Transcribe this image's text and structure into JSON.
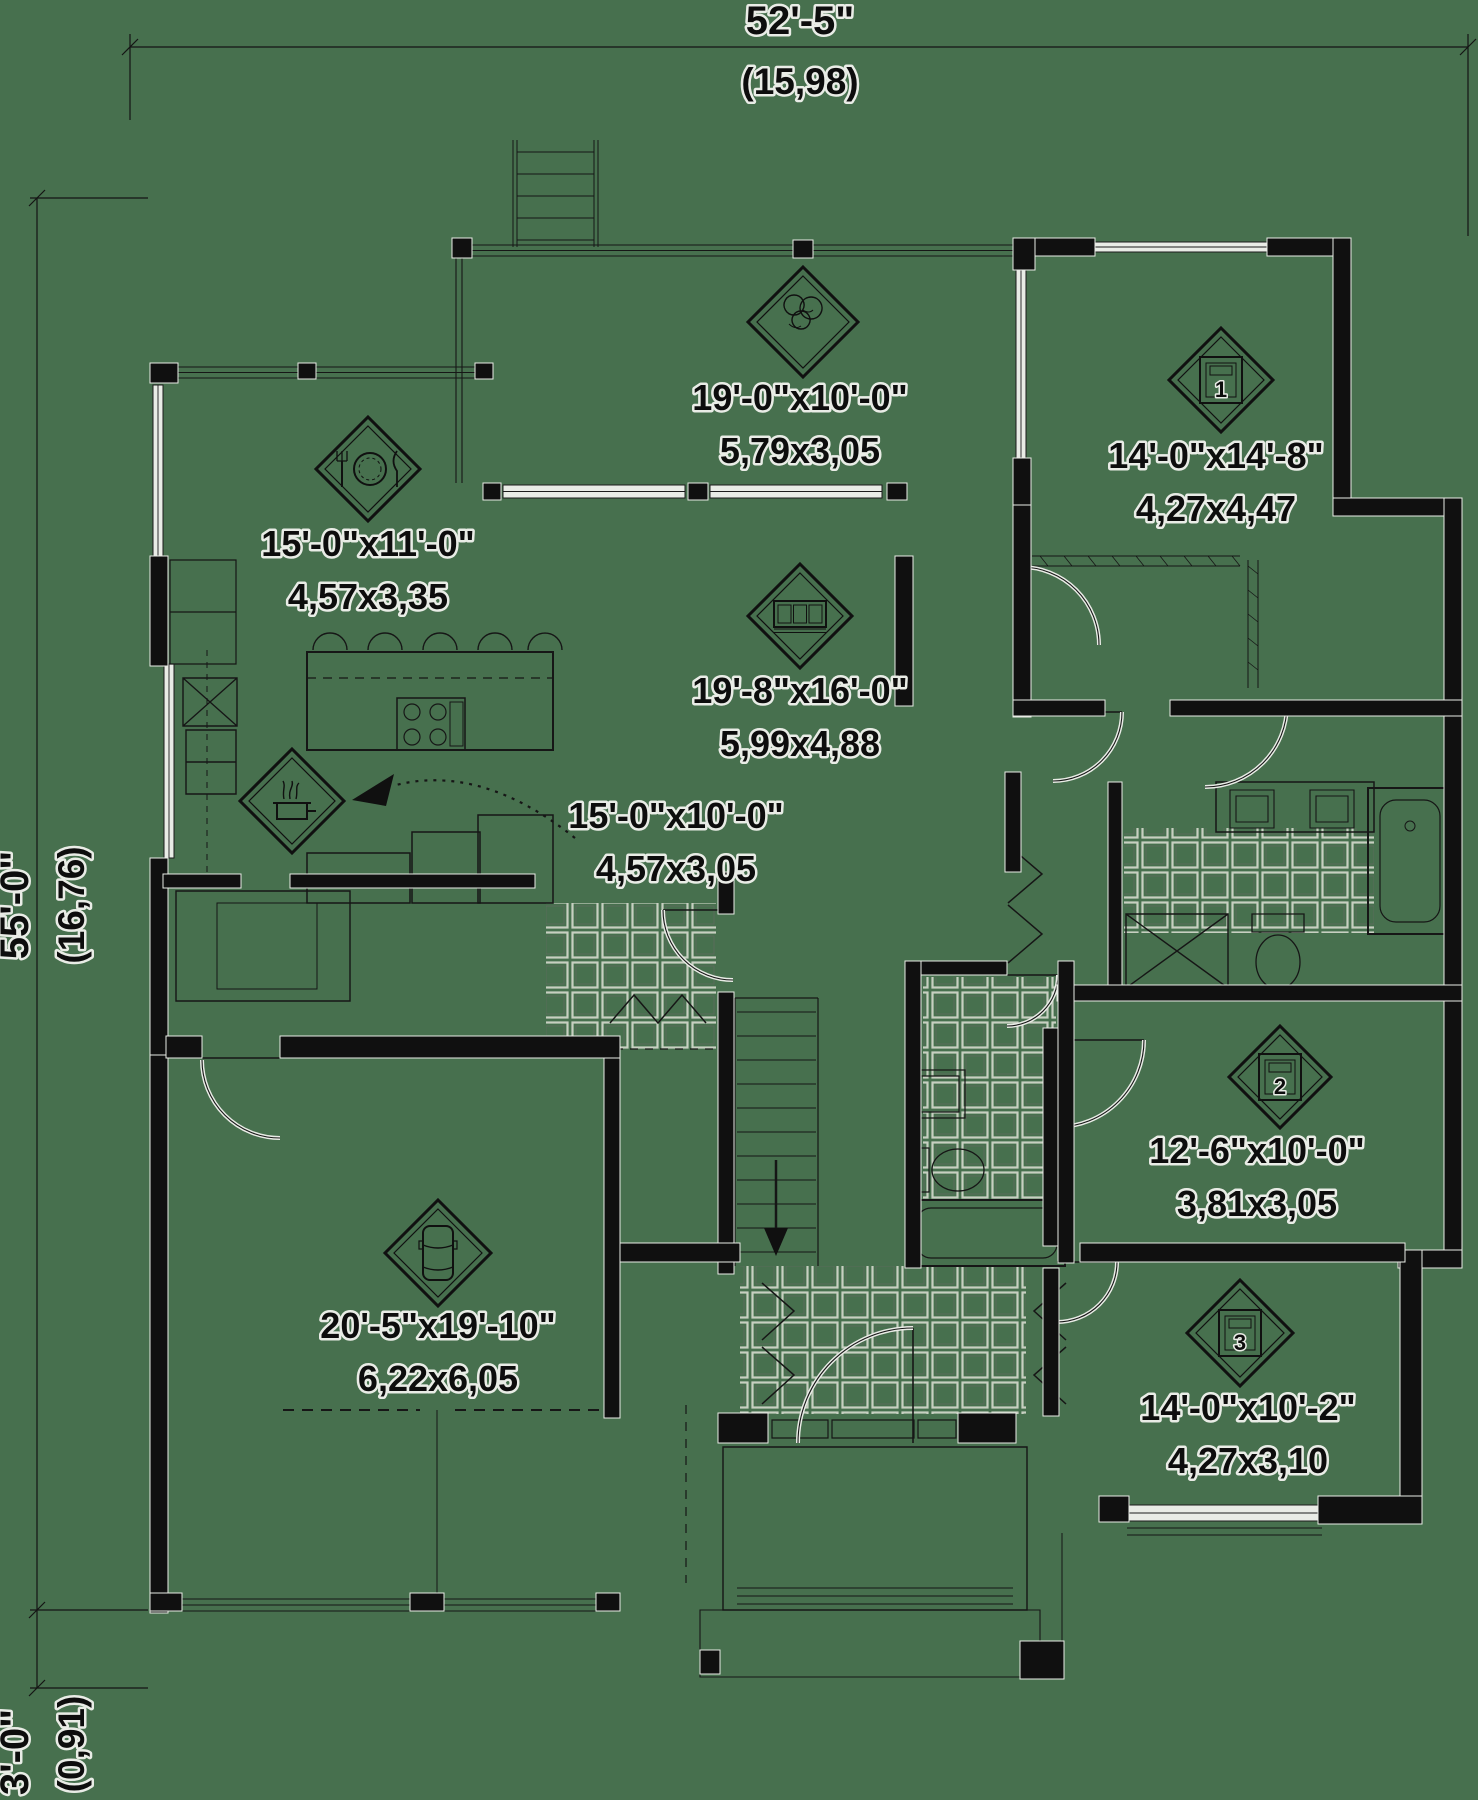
{
  "drawing_type": "house-floor-plan",
  "colors": {
    "background": "#47704E",
    "ink": "#0d0d0d",
    "halo": "#e9ece6",
    "tile": "#c7cfc1"
  },
  "dimension_labels": {
    "top": {
      "imperial": "52'-5\"",
      "metric": "(15,98)"
    },
    "left": {
      "imperial": "55'-0\"",
      "metric": "(16,76)"
    },
    "left_lower": {
      "imperial": "3'-0\"",
      "metric": "(0,91)"
    }
  },
  "rooms": [
    {
      "key": "terrace",
      "icon": "terrace-icon",
      "imperial": "19'-0\"x10'-0\"",
      "metric": "5,79x3,05",
      "diamond": {
        "cx": 803,
        "cy": 322,
        "r": 55
      },
      "label": {
        "x": 800,
        "y": 410
      }
    },
    {
      "key": "master-bedroom",
      "icon": "bed-icon",
      "number": "1",
      "imperial": "14'-0\"x14'-8\"",
      "metric": "4,27x4,47",
      "diamond": {
        "cx": 1221,
        "cy": 380,
        "r": 52
      },
      "label": {
        "x": 1216,
        "y": 468
      }
    },
    {
      "key": "dining-room",
      "icon": "dining-icon",
      "imperial": "15'-0\"x11'-0\"",
      "metric": "4,57x3,35",
      "diamond": {
        "cx": 368,
        "cy": 469,
        "r": 52
      },
      "label": {
        "x": 368,
        "y": 556
      }
    },
    {
      "key": "living-room",
      "icon": "sofa-icon",
      "imperial": "19'-8\"x16'-0\"",
      "metric": "5,99x4,88",
      "diamond": {
        "cx": 800,
        "cy": 616,
        "r": 52
      },
      "label": {
        "x": 800,
        "y": 703
      }
    },
    {
      "key": "kitchen",
      "icon": "kitchen-icon",
      "imperial": "15'-0\"x10'-0\"",
      "metric": "4,57x3,05",
      "diamond": {
        "cx": 292,
        "cy": 801,
        "r": 52
      },
      "label": {
        "x": 676,
        "y": 828
      }
    },
    {
      "key": "garage",
      "icon": "car-icon",
      "imperial": "20'-5\"x19'-10\"",
      "metric": "6,22x6,05",
      "diamond": {
        "cx": 438,
        "cy": 1253,
        "r": 53
      },
      "label": {
        "x": 438,
        "y": 1338
      }
    },
    {
      "key": "bedroom-2",
      "icon": "bed-icon",
      "number": "2",
      "imperial": "12'-6\"x10'-0\"",
      "metric": "3,81x3,05",
      "diamond": {
        "cx": 1280,
        "cy": 1077,
        "r": 51
      },
      "label": {
        "x": 1257,
        "y": 1163
      }
    },
    {
      "key": "bedroom-3",
      "icon": "bed-icon",
      "number": "3",
      "imperial": "14'-0\"x10'-2\"",
      "metric": "4,27x3,10",
      "diamond": {
        "cx": 1240,
        "cy": 1333,
        "r": 53
      },
      "label": {
        "x": 1248,
        "y": 1420
      }
    }
  ]
}
